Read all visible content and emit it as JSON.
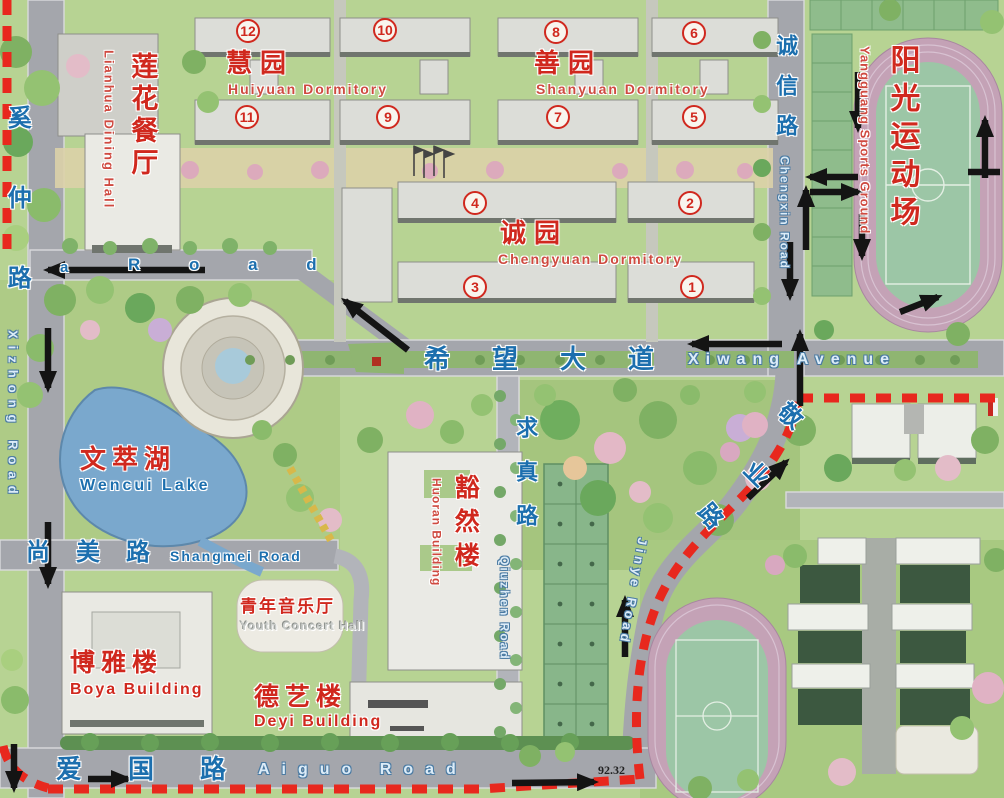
{
  "annotation": "92.32",
  "roads": {
    "xizhong": {
      "zh": "奚仲路",
      "en": "Xizhong Road"
    },
    "north_road": {
      "prefix": "a",
      "en": "R o a d"
    },
    "xiwang": {
      "zh": "希望大道",
      "en": "Xiwang Avenue"
    },
    "chengxin": {
      "zh": "诚信路",
      "en": "Chengxin Road"
    },
    "qiuzhen": {
      "zh": "求真路",
      "en": "Qiuzhen Road"
    },
    "shangmei": {
      "zh": "尚美路",
      "en": "Shangmei Road"
    },
    "aiguo": {
      "zh": "爱国路",
      "en": "Aiguo Road"
    },
    "jinye": {
      "zh_chars": [
        "敬",
        "业",
        "路"
      ],
      "en": "Jinye Road"
    }
  },
  "places": {
    "lianhua": {
      "zh": "莲花餐厅",
      "en": "Lianhua Dining Hall"
    },
    "huiyuan": {
      "zh": "慧园",
      "en": "Huiyuan Dormitory"
    },
    "shanyuan": {
      "zh": "善园",
      "en": "Shanyuan Dormitory"
    },
    "chengyuan": {
      "zh": "诚园",
      "en": "Chengyuan Dormitory"
    },
    "yangguang": {
      "zh": "阳光运动场",
      "en": "Yangguang Sports Ground"
    },
    "wencui": {
      "zh": "文萃湖",
      "en": "Wencui Lake"
    },
    "huoran": {
      "zh": "豁然楼",
      "en": "Huoran Building"
    },
    "concert": {
      "zh": "青年音乐厅",
      "en": "Youth Concert Hall"
    },
    "boya": {
      "zh": "博雅楼",
      "en": "Boya Building"
    },
    "deyi": {
      "zh": "德艺楼",
      "en": "Deyi Building"
    }
  },
  "building_numbers": {
    "n1": "1",
    "n2": "2",
    "n3": "3",
    "n4": "4",
    "n5": "5",
    "n6": "6",
    "n7": "7",
    "n8": "8",
    "n9": "9",
    "n10": "10",
    "n11": "11",
    "n12": "12"
  },
  "colors": {
    "boundary_red": "#e8281e",
    "label_red": "#d0281e",
    "label_blue": "#1c6fae",
    "track": "#c4a2b6",
    "sports_field": "#9cc6a6",
    "lake": "#7aa8cd",
    "arrow": "#141414"
  }
}
